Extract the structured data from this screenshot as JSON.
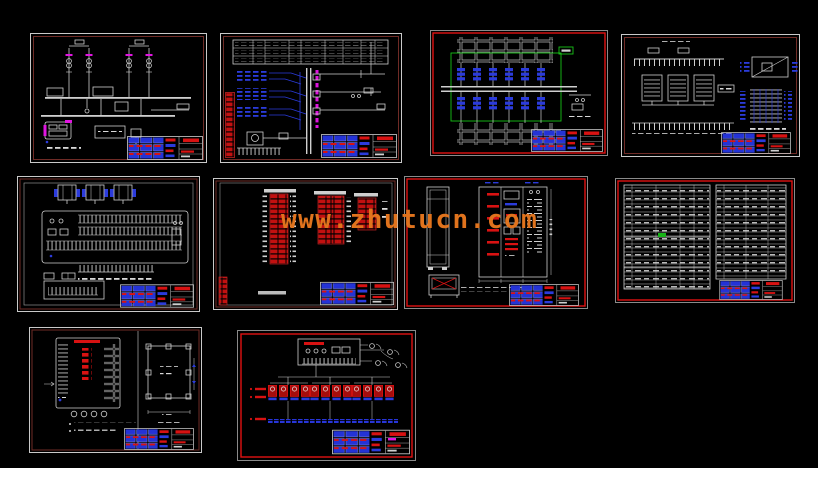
{
  "page": {
    "background": "#000000",
    "footer_strip_color": "#ffffff"
  },
  "watermark": {
    "text": "www.zhutucn.com",
    "color": "#e0731d"
  },
  "palette": {
    "sheet_outline": "#c9c9c9",
    "frame_dark_red": "#6f2b26",
    "frame_bright_red": "#e01212",
    "wire_white": "#cfcfcf",
    "device_blue": "#2b3bdc",
    "annotation_red": "#d81212",
    "terminal_red": "#c21010",
    "highlight_magenta": "#e015e0",
    "highlight_green": "#18c418",
    "titleblock_blue": "#2433d6"
  },
  "sheets": [
    {
      "index": 1,
      "kind": "power-single-line-diagram",
      "border": "border-dark"
    },
    {
      "index": 2,
      "kind": "control-schematic",
      "border": "border-dark"
    },
    {
      "index": 3,
      "kind": "feeder-breaker-diagram",
      "border": "border-bright"
    },
    {
      "index": 4,
      "kind": "terminal-wiring-detail",
      "border": "border-dark"
    },
    {
      "index": 5,
      "kind": "panel-terminal-layout",
      "border": "border-dark"
    },
    {
      "index": 6,
      "kind": "terminal-strip-tables",
      "border": "border-dark"
    },
    {
      "index": 7,
      "kind": "cabinet-elevation",
      "border": "border-bright"
    },
    {
      "index": 8,
      "kind": "equipment-material-list",
      "border": "border-bright"
    },
    {
      "index": 9,
      "kind": "controller-mounting-detail",
      "border": "border-dark"
    },
    {
      "index": 10,
      "kind": "system-network-diagram",
      "border": "border-bright"
    }
  ]
}
